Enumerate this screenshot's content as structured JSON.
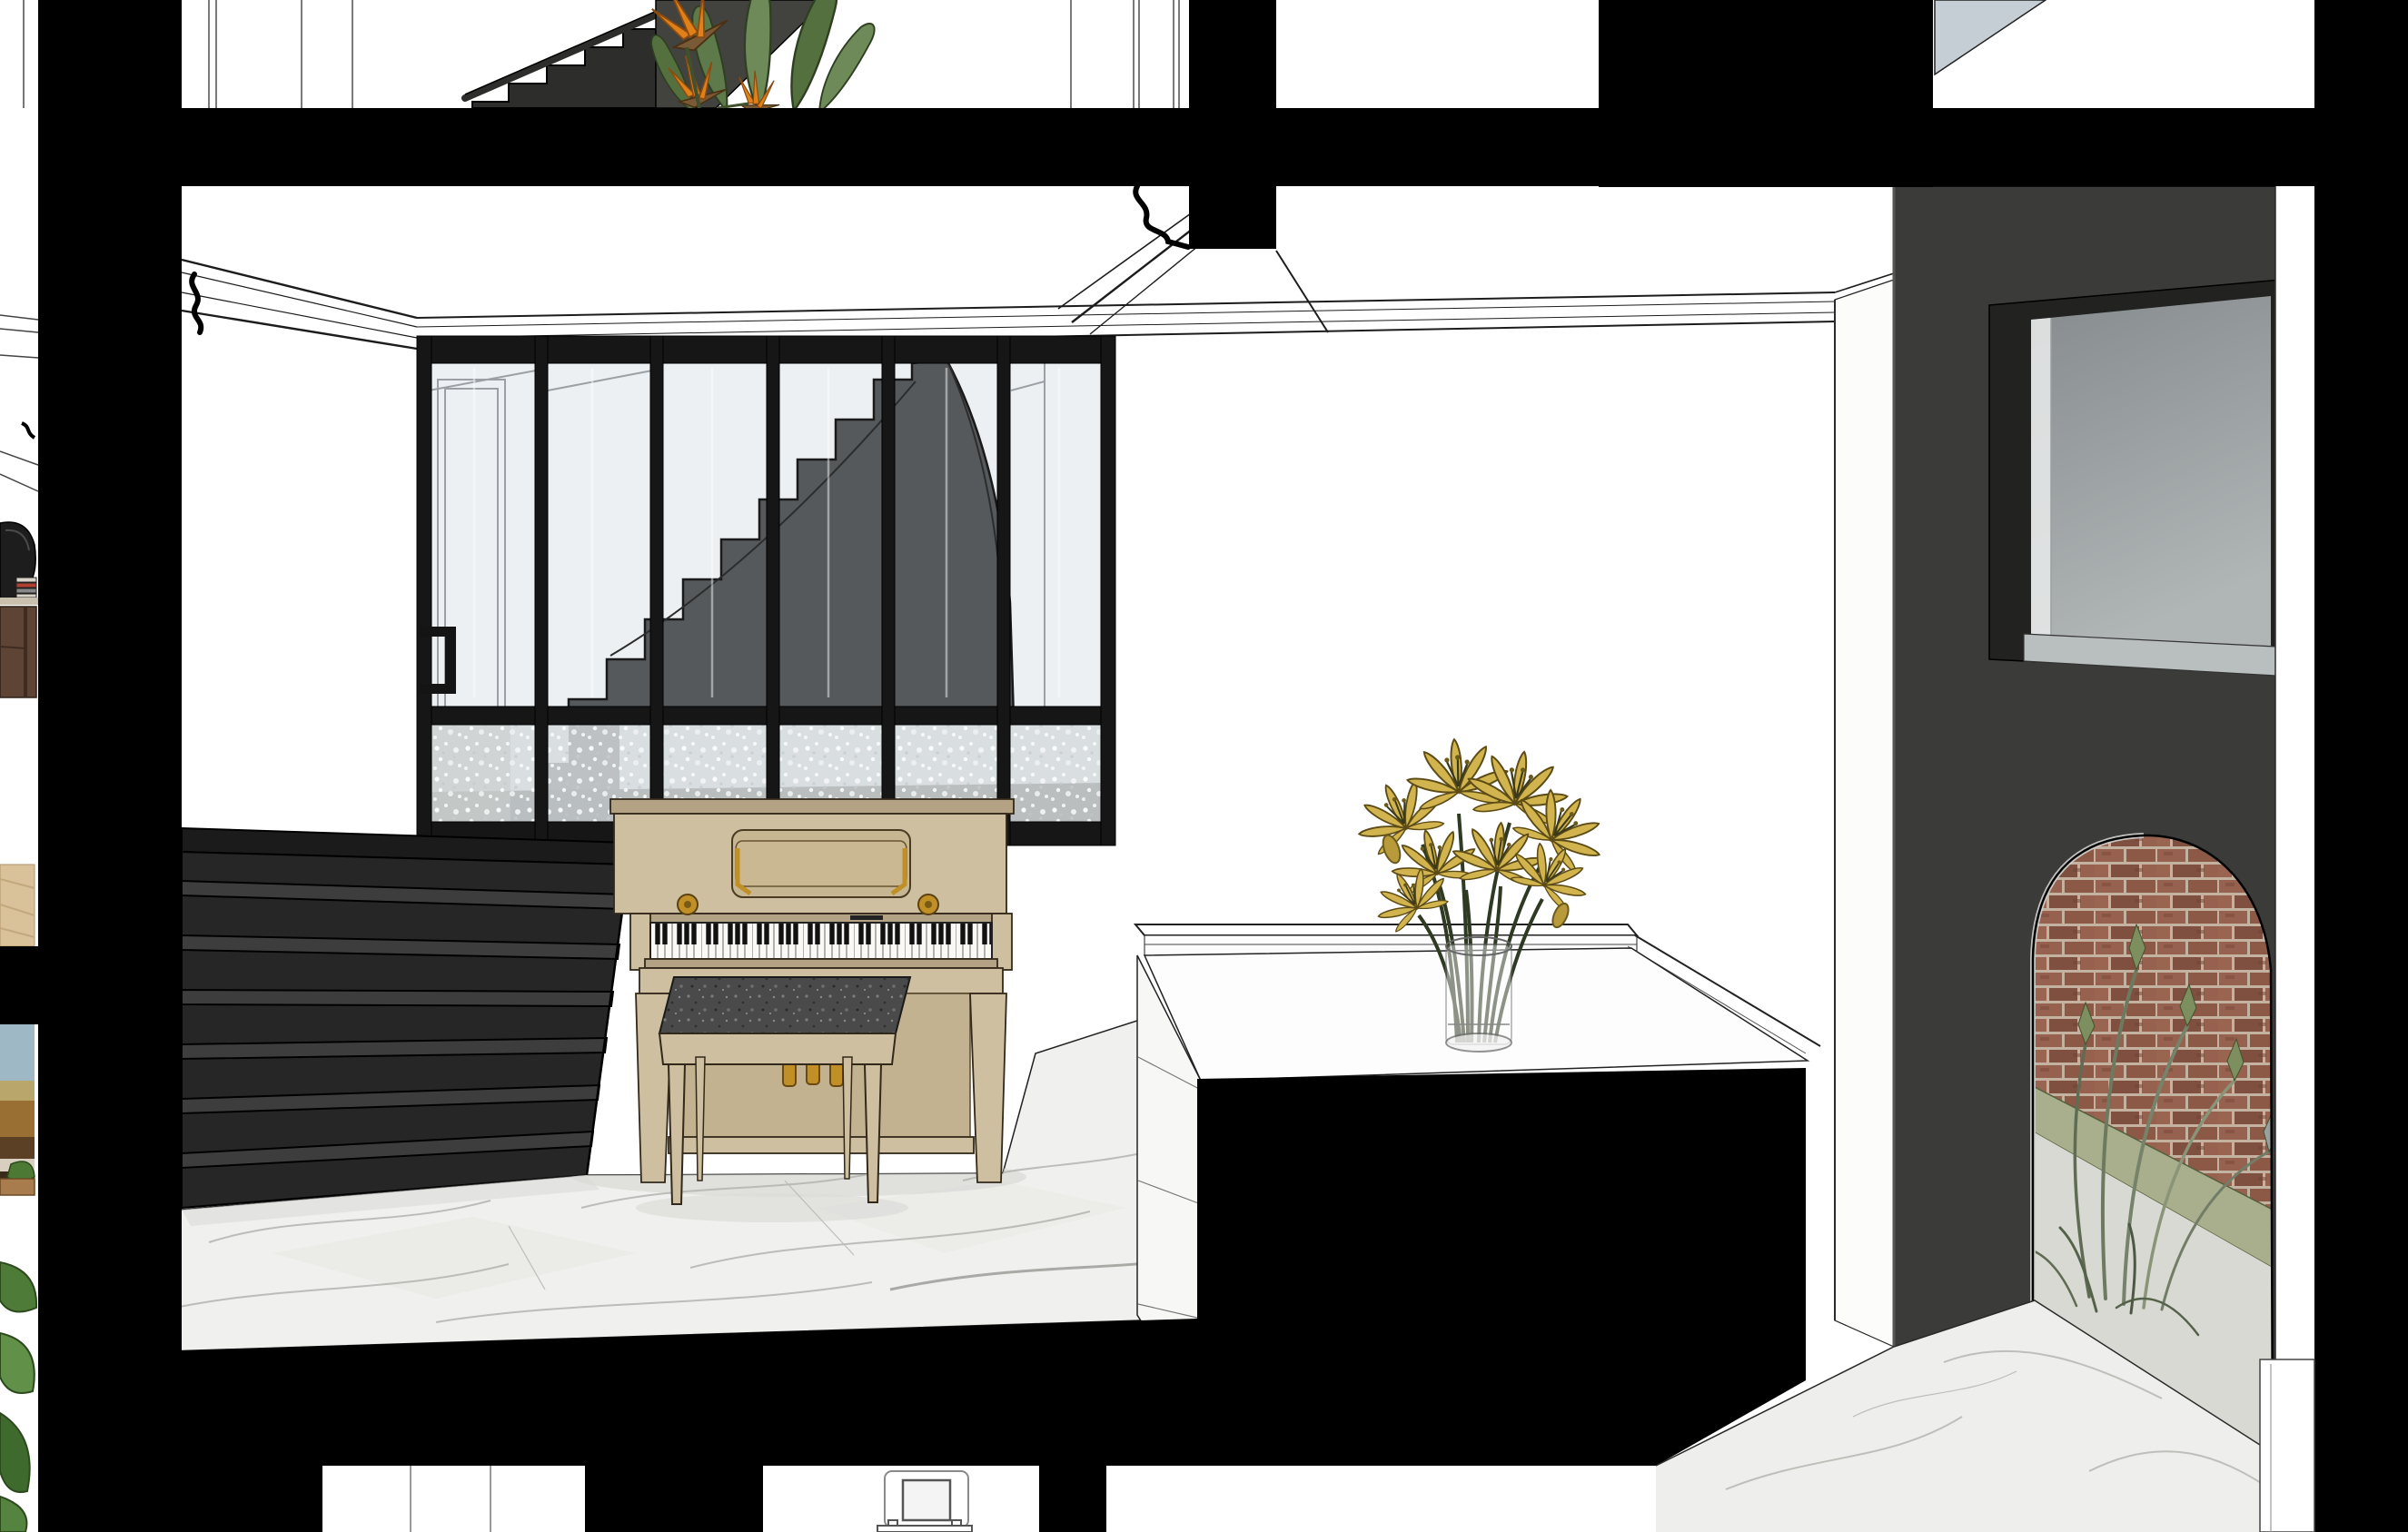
{
  "scene": {
    "label": "architectural-section-render",
    "description": "Monochrome cutaway section perspective of a townhouse interior with black poche walls",
    "objects": {
      "poche": {
        "label": "section-cut black walls and slabs"
      },
      "upper_floor": {
        "label": "upper floor landing with dark stair and bird-of-paradise plant"
      },
      "bop_plant": {
        "label": "bird-of-paradise plant"
      },
      "cornice": {
        "label": "crown moulding"
      },
      "partition": {
        "label": "black steel glazed partition with frosted lower panels"
      },
      "partition_door_handle": {
        "label": "partition door pull handle"
      },
      "curved_stair": {
        "label": "curved grey staircase behind glazing"
      },
      "front_stair": {
        "label": "black painted staircase"
      },
      "piano": {
        "label": "light oak upright piano"
      },
      "piano_bench": {
        "label": "piano bench with grey cushion"
      },
      "piano_pedals": {
        "label": "three brass pedals"
      },
      "marble_floor": {
        "label": "white marble floor with grey veining"
      },
      "island": {
        "label": "white kitchen island counter with black base"
      },
      "vase": {
        "label": "glass cylinder vase"
      },
      "lilies": {
        "label": "yellow lily bouquet"
      },
      "entry_wall": {
        "label": "charcoal entry wall"
      },
      "interior_window": {
        "label": "grey interior window"
      },
      "arch": {
        "label": "arched opening to brick courtyard"
      },
      "brick": {
        "label": "red brick wall"
      },
      "grass": {
        "label": "ornamental courtyard grass"
      },
      "entry_floor": {
        "label": "marble entry floor"
      },
      "pilaster": {
        "label": "white pilaster"
      },
      "wall_plate": {
        "label": "wall switch plate in lower room"
      },
      "left_slivers": {
        "label": "adjacent rooms seen at left edge: speaker, sideboard, painting, plant leaves"
      },
      "sky_triangle": {
        "label": "blue-grey ceiling plane fragment"
      }
    }
  },
  "palette": {
    "poche": "#000000",
    "charcoal": "#3b3b39",
    "stair-front": "#262626",
    "stair-grey": "#55595b",
    "wood": "#cdbf9f",
    "wood-dark": "#b3a284",
    "gold": "#c09026",
    "marble": "#f0f0ee",
    "glass": "#edf0f2",
    "frosted": "#d9dee1",
    "brick": "#95604e",
    "mortar": "#c4b2a0",
    "hedge": "#a9af8d",
    "concrete": "#d9d9d3",
    "lily": "#d2b44e",
    "leaf": "#5f7a4a",
    "bop-orange": "#e08018",
    "window-glass": "#8e9396",
    "sky": "#c5ced4"
  }
}
